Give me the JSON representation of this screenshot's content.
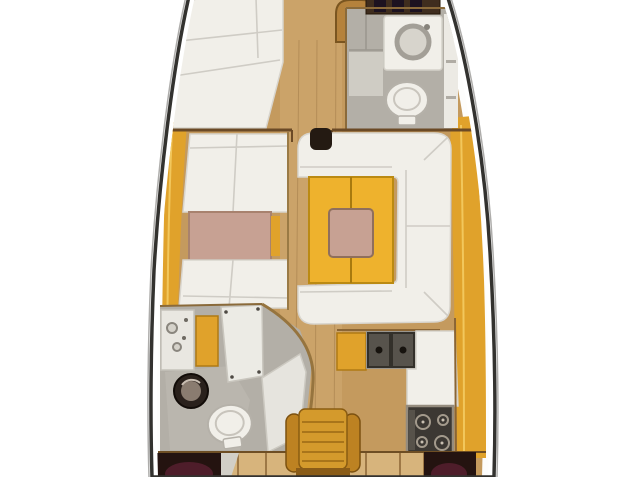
{
  "title": "Sailing yacht interior layout floor plan, top view",
  "colors": {
    "background": "#ffffff",
    "hull_outline": "#33322f",
    "hull_inner_white": "#fdfdfc",
    "wood_floor": "#c49a5e",
    "wood_floor_light": "#d7b47c",
    "wood_trim": "#7a5526",
    "bulkhead": "#6b4a26",
    "deck_amber": "#e0a22b",
    "deck_amber_highlight": "#f2c75c",
    "deck_amber_dark": "#b07a14",
    "furniture_white": "#f1efe9",
    "panel_white": "#e9e7e1",
    "seam_gray": "#c9c6be",
    "head_floor_gray": "#b3afa7",
    "head_floor_light": "#cfccc4",
    "table_pink": "#c7a193",
    "table_yellow": "#eeb22d",
    "table_yellow_dark": "#bb8a12",
    "appliance_frame": "#9a968e",
    "appliance_dark": "#3c3833",
    "sink_basin": "#57534c",
    "washer_dark": "#2a211c",
    "washer_drum": "#8a7c70",
    "shelf_dark": "#3f2d1e",
    "bottle_dark": "#1c1220",
    "post_dark": "#241a12",
    "berth_maroon": "#4e1d2a",
    "locker_dark": "#241310",
    "chair_back": "#d49a2c",
    "chair_arm": "#bd8222",
    "chair_slat": "#a9751a",
    "chair_base": "#8a5c18",
    "toilet_stroke": "#b5b1a9"
  },
  "regions": {
    "forward_cabin": "v-berth-forward-cabin",
    "forward_head": "forward-head",
    "port_settee": "port-settee-with-table",
    "salon_sofa": "starboard-sofa-with-folding-table",
    "galley": "l-shaped-galley",
    "aft_head": "aft-head-with-washer",
    "nav_seat": "chart-table-seat",
    "aft_berths": "aft-cabin-berths"
  }
}
